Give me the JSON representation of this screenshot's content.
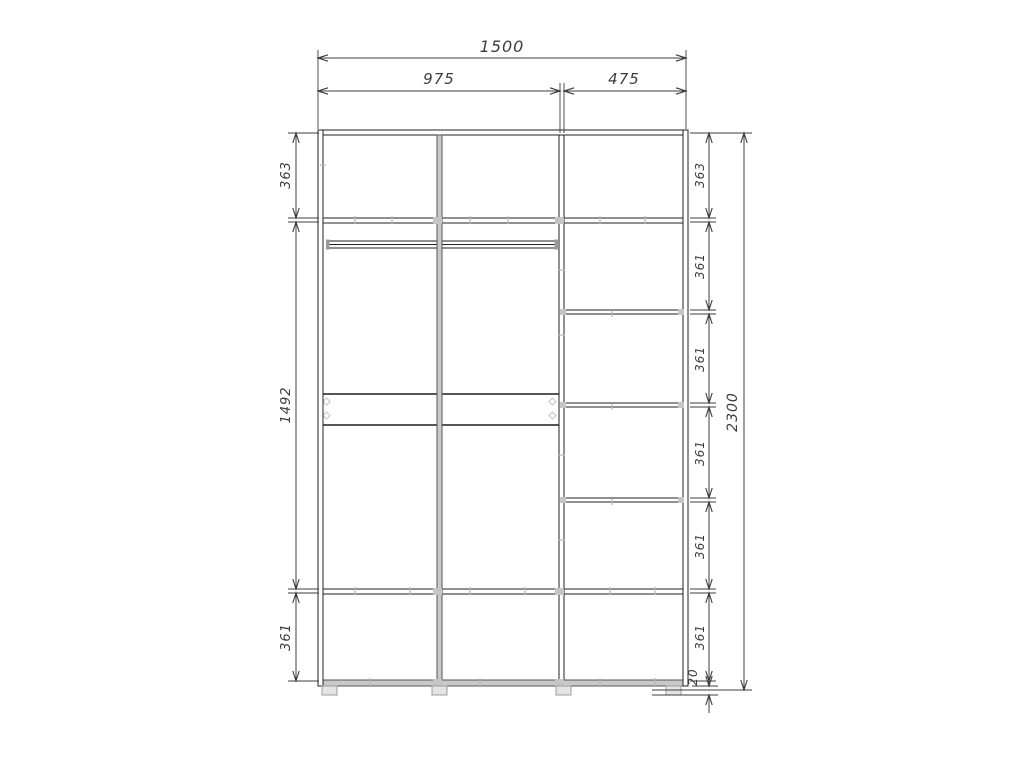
{
  "drawing": {
    "kind": "wardrobe-dimension-drawing",
    "view": "front-elevation"
  },
  "dimensions": {
    "top": [
      {
        "name": "overall-width",
        "label": "1500"
      },
      {
        "name": "left-section-width",
        "label": "975"
      },
      {
        "name": "right-section-width",
        "label": "475"
      }
    ],
    "left": [
      {
        "name": "top-compartment-height",
        "label": "363"
      },
      {
        "name": "middle-section-height",
        "label": "1492"
      },
      {
        "name": "bottom-compartment-height",
        "label": "361"
      }
    ],
    "right": [
      {
        "name": "compartment-1-height",
        "label": "363"
      },
      {
        "name": "compartment-2-height",
        "label": "361"
      },
      {
        "name": "compartment-3-height",
        "label": "361"
      },
      {
        "name": "compartment-4-height",
        "label": "361"
      },
      {
        "name": "compartment-5-height",
        "label": "361"
      },
      {
        "name": "compartment-6-height",
        "label": "361"
      },
      {
        "name": "plinth-height",
        "label": "20"
      },
      {
        "name": "overall-height",
        "label": "2300"
      }
    ]
  },
  "colors": {
    "background": "#ffffff",
    "structure_line": "#222222",
    "dimension_line": "#3c3c3c",
    "highlight_gray": "#c9c9c9"
  }
}
